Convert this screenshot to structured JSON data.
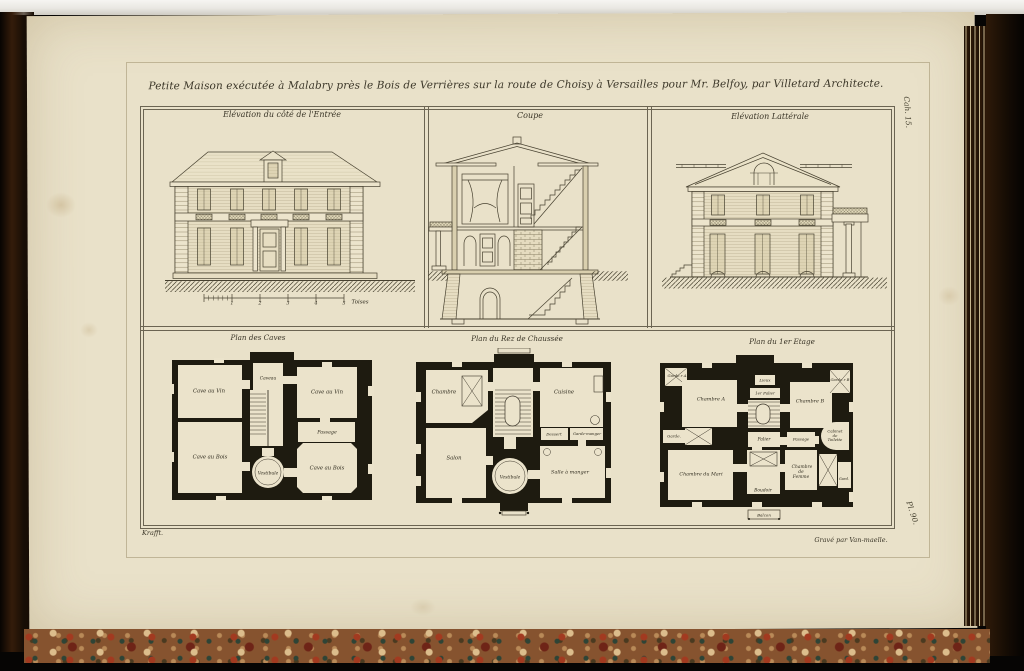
{
  "colors": {
    "page": "#e9e1c9",
    "ink": "#474130",
    "plan_wall": "#1e1b10",
    "cover_leather": "#2e1a09",
    "marble_base": "#86532f"
  },
  "plate": {
    "title": "Petite Maison exécutée à Malabry près le Bois de Verrières sur la route de Choisy à Versailles pour Mr. Belfoy, par Villetard Architecte.",
    "cahier": "Cah. 15.",
    "plate_number": "Pl. 90.",
    "credit_left": "Krafft.",
    "credit_right": "Gravé par Van-maelle."
  },
  "panels": {
    "front": {
      "title": "Elévation du côté de l'Entrée"
    },
    "coupe": {
      "title": "Coupe"
    },
    "side": {
      "title": "Elévation Lattérale"
    }
  },
  "scale": {
    "ticks": [
      "1",
      "2",
      "3",
      "4",
      "5"
    ],
    "unit": "Toises"
  },
  "plans": {
    "caves": {
      "title": "Plan des Caves",
      "rooms": {
        "cave_vin_left": "Cave au Vin",
        "caveau": "Caveau",
        "cave_vin_right": "Cave au Vin",
        "passage": "Passage",
        "cave_bois_left": "Cave au Bois",
        "vestibule": "Vestibule",
        "cave_bois_right": "Cave au Bois"
      }
    },
    "rez": {
      "title": "Plan du Rez de Chaussée",
      "rooms": {
        "chambre": "Chambre",
        "cuisine": "Cuisine",
        "dessert": "Dessert",
        "garde_manger": "Garde-manger",
        "salon": "Salon",
        "vestibule": "Vestibule",
        "salle_a_manger": "Salle à manger"
      }
    },
    "etage": {
      "title": "Plan du 1er Etage",
      "rooms": {
        "garde_a": "Garde.r A",
        "chambre_a": "Chambre A",
        "lieux": "Lieux",
        "premier_palier": "1er Palier",
        "chambre_b": "Chambre B",
        "garde_b": "Garde.r B",
        "garde_left": "Garde.",
        "palier": "Palier",
        "passage": "Passage",
        "cabinet_toilette": "Cabinet de Toilette",
        "chambre_mari": "Chambre du Mari",
        "boudoir": "Boudoir",
        "chambre_femme": "Chambre de Femme",
        "gard": "Gard.",
        "balcon": "Balcon"
      }
    }
  }
}
